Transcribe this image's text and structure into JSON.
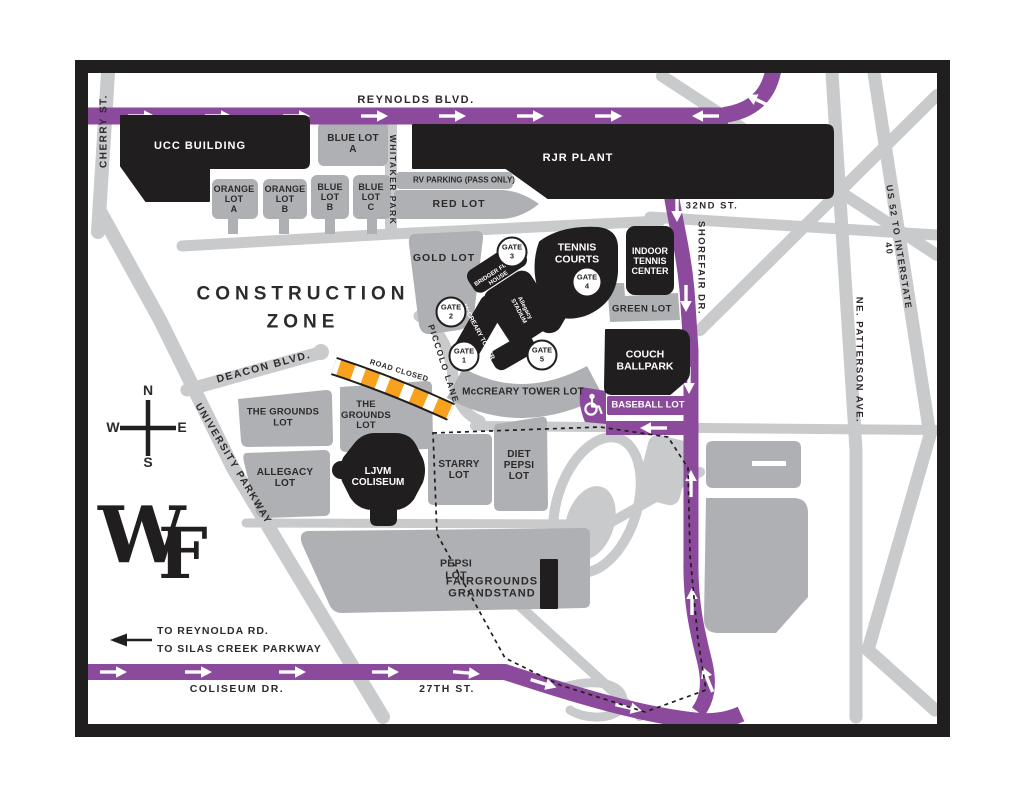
{
  "streets": {
    "cherry": "CHERRY ST.",
    "reynolds": "REYNOLDS BLVD.",
    "whitaker": "WHITAKER PARK",
    "thirty_second": "32ND ST.",
    "shorefair": "SHOREFAIR DR.",
    "us52": "US 52 TO INTERSTATE 40",
    "patterson": "NE. PATTERSON AVE.",
    "deacon": "DEACON BLVD.",
    "piccolo": "PICCOLO LANE",
    "university": "UNIVERSITY PARKWAY",
    "coliseum_dr": "COLISEUM DR.",
    "twenty_seventh": "27TH ST."
  },
  "buildings": {
    "ucc": "UCC BUILDING",
    "rjr": "RJR PLANT",
    "tennis_courts": "TENNIS\nCOURTS",
    "indoor_tennis": "INDOOR\nTENNIS\nCENTER",
    "couch": "COUCH\nBALLPARK",
    "ljvm": "LJVM\nCOLISEUM",
    "grandstand": "FAIRGROUNDS\nGRANDSTAND",
    "bridger": "BRIDGER FIELD\nHOUSE",
    "mccreary_tower": "McCREARY TOWER",
    "stadium_logo": "Allegacy\nSTADIUM"
  },
  "lots": {
    "blue_a": "BLUE LOT\nA",
    "orange_a": "ORANGE\nLOT\nA",
    "orange_b": "ORANGE\nLOT\nB",
    "blue_b": "BLUE\nLOT\nB",
    "blue_c": "BLUE\nLOT\nC",
    "rv": "RV PARKING (PASS ONLY)",
    "red": "RED LOT",
    "gold": "GOLD LOT",
    "green": "GREEN LOT",
    "mccreary": "McCREARY TOWER LOT",
    "baseball": "BASEBALL LOT",
    "grounds_left": "THE GROUNDS\nLOT",
    "grounds_right": "THE\nGROUNDS\nLOT",
    "allegacy": "ALLEGACY\nLOT",
    "starry": "STARRY\nLOT",
    "diet_pepsi": "DIET\nPEPSI\nLOT",
    "pepsi": "PEPSI\nLOT"
  },
  "gates": {
    "g1": "GATE\n1",
    "g2": "GATE\n2",
    "g3": "GATE\n3",
    "g4": "GATE\n4",
    "g5": "GATE\n5"
  },
  "annotations": {
    "construction": "CONSTRUCTION\nZONE",
    "road_closed": "ROAD CLOSED",
    "to_reynolda": "TO REYNOLDA RD.",
    "to_silas": "TO SILAS CREEK PARKWAY",
    "wf_w": "W",
    "wf_f": "F"
  },
  "compass": {
    "n": "N",
    "e": "E",
    "s": "S",
    "w": "W"
  },
  "icons": {
    "accessible_parking": "wheelchair-icon"
  },
  "colors": {
    "route_purple": "#8C4A9C",
    "road_gray": "#C9CACC",
    "lot_gray": "#AEB0B3",
    "building_black": "#211E1F",
    "road_closed_orange": "#F7A11E"
  }
}
